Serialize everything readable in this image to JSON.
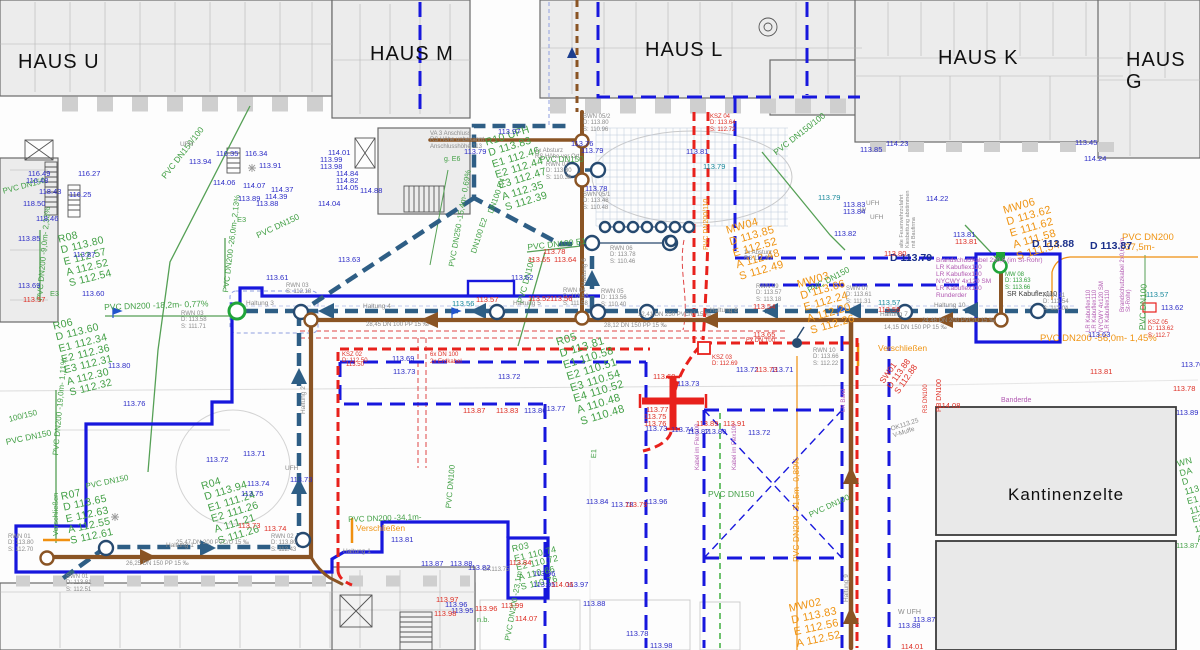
{
  "canvas": {
    "width": 1200,
    "height": 650
  },
  "colors": {
    "boundary_blue": "#1717dd",
    "main_teal": "#2e5e85",
    "pipe_brown": "#8a5424",
    "ksz_red": "#e8211c",
    "existing_green": "#43a046",
    "new_orange": "#ef9413",
    "cable_magenta": "#b25ab2",
    "elev_blue": "#2b2bc6",
    "elev_red": "#dd2e24",
    "building_fill": "#ececec",
    "manhole_navy": "#274a70",
    "marker_green": "#21a53a"
  },
  "labels": [
    [
      "HAUS U",
      18,
      52,
      "bld",
      0,
      20
    ],
    [
      "HAUS M",
      370,
      44,
      "bld",
      0,
      20
    ],
    [
      "HAUS L",
      645,
      40,
      "bld",
      0,
      20
    ],
    [
      "HAUS K",
      938,
      48,
      "bld",
      0,
      20
    ],
    [
      "HAUS G",
      1126,
      50,
      "bld",
      0,
      20
    ],
    [
      "Kantinenzelte",
      1008,
      486,
      "bld",
      0,
      17
    ],
    [
      "R10  UFH\nD  113.83\nE1 112.46\nE2 112.44\nE3 112.47\nA  112.35\nS  112.39",
      484,
      138,
      "gb",
      -17,
      10.5
    ],
    [
      "R08\nD 113.80\nE 112.57\nA 112.52\nS 112.54",
      57,
      235,
      "gb",
      -14,
      10.5
    ],
    [
      "R06\nD  113.60\nE1 112.34\nE2 112.36\nE3 112.31\nA  112.30\nS  112.32",
      52,
      322,
      "gb",
      -14,
      10.5
    ],
    [
      "R07\nD 113.65\nE 112.63\nA 112.55\nS 112.61",
      60,
      492,
      "gb",
      -12,
      10.5
    ],
    [
      "R04\nD  113.94\nE1 111.24\nE2 111.26\nA  111.21\nS  111.26",
      200,
      482,
      "gb",
      -17,
      10.5
    ],
    [
      "R05\nD  113.81\nE1 110.58\nE2 110.51\nE3 110.54\nE4 110.52\nA  110.48\nS  110.48",
      555,
      338,
      "gb",
      -17,
      11
    ],
    [
      "R03\nE1 110.74\nE2 110.72\nA  110.66\nS  110.76",
      511,
      545,
      "gb",
      -13,
      9
    ],
    [
      "WN DA\nD 113.85\nE1 113.2\nE2 113.1\nA 113.0\nS 113.0",
      1176,
      460,
      "gb",
      -15,
      9
    ],
    [
      "MW04\nD 113.85\nE 112.52\nA 112.48\nS 112.49",
      725,
      226,
      "ob",
      -16,
      11
    ],
    [
      "MW03\nD 113.66\nE 112.24\nA 112.20\nS 112.26",
      796,
      280,
      "ob",
      -16,
      11
    ],
    [
      "MW06\nD 113.62\nE 111.62\nA 111.58\nS 111.54",
      1002,
      206,
      "ob",
      -16,
      11
    ],
    [
      "MW02\nD 113.83\nE 112.56\nA 112.52",
      788,
      604,
      "ob",
      -12,
      11
    ],
    [
      "PVC DN150/100",
      160,
      175,
      "g",
      -52,
      8.5
    ],
    [
      "PVC DN150/100",
      772,
      150,
      "g",
      -38,
      8.5
    ],
    [
      "PVC DN150",
      255,
      232,
      "g",
      -25,
      8.5
    ],
    [
      "PVC DN150",
      806,
      287,
      "g",
      -28,
      8.5
    ],
    [
      "PVC DN100  E1",
      527,
      243,
      "g",
      -6,
      8.5
    ],
    [
      "PVC DN100",
      516,
      302,
      "g",
      -75,
      8.5
    ],
    [
      "PVC DN200 -18,2m- 0,77%",
      104,
      303,
      "g",
      -2,
      8.5
    ],
    [
      "PVC DN200 -9,0m- 2,33%",
      36,
      300,
      "g",
      -85,
      8
    ],
    [
      "PVC DN200 -26,0m- 2,13%",
      222,
      292,
      "g",
      -83,
      8
    ],
    [
      "PVC DN250 -15,4m- 0,69%",
      448,
      266,
      "g",
      -80,
      8
    ],
    [
      "DN100 E2",
      470,
      252,
      "g",
      -72,
      8
    ],
    [
      "DN100 E4",
      487,
      212,
      "g",
      -70,
      8
    ],
    [
      "g. E6",
      444,
      156,
      "g",
      0,
      7
    ],
    [
      "PVC DN150",
      540,
      156,
      "g",
      0,
      8
    ],
    [
      "PVC DN150",
      2,
      188,
      "g",
      -15,
      8
    ],
    [
      "100/150",
      8,
      416,
      "g",
      -14,
      8
    ],
    [
      "PVC DN150",
      5,
      438,
      "g",
      -12,
      8.5
    ],
    [
      "PVC DN200 -19,0m- 1,11%",
      52,
      455,
      "g",
      -85,
      8
    ],
    [
      "PVC DN150",
      85,
      483,
      "g",
      -12,
      8
    ],
    [
      "PVC DN200 -34,1m-",
      348,
      516,
      "g",
      -2,
      8
    ],
    [
      "PVC DN100",
      445,
      508,
      "g",
      -85,
      8
    ],
    [
      "PVC DN200 -23,1m",
      504,
      640,
      "g",
      -80,
      8
    ],
    [
      "n.b.",
      477,
      616,
      "g",
      0,
      7.5
    ],
    [
      "PVC DN150",
      708,
      490,
      "g",
      0,
      8.5
    ],
    [
      "PVC DN100",
      808,
      512,
      "g",
      -25,
      8
    ],
    [
      "PVC DN100",
      1138,
      330,
      "g",
      -88,
      8.5
    ],
    [
      "E3",
      50,
      290,
      "g",
      0,
      7.5
    ],
    [
      "E3",
      237,
      216,
      "g",
      0,
      7.5
    ],
    [
      "E1",
      590,
      458,
      "g",
      -88,
      7.5
    ],
    [
      "113.87",
      1176,
      542,
      "g",
      0,
      7.5
    ],
    [
      "MW 08\nD: 113.63\nS: 113.66",
      1005,
      272,
      "gg",
      0,
      6
    ],
    [
      "Verschließen",
      52,
      536,
      "g",
      -90,
      7.5
    ],
    [
      "Verschließen",
      878,
      344,
      "o",
      0,
      8.5
    ],
    [
      "Verschließen",
      356,
      524,
      "o",
      0,
      8.5
    ],
    [
      "PVC DN200 -37,5m-",
      1122,
      233,
      "o",
      0,
      9.5
    ],
    [
      "PVC DN200 -56,0m- 1,45%",
      1040,
      334,
      "o",
      0,
      9.5
    ],
    [
      "PVC DN200/110",
      703,
      250,
      "o",
      -90,
      7
    ],
    [
      "PVC DN200 -31,5m- 0,89%",
      792,
      562,
      "o",
      -90,
      8.5
    ],
    [
      "Brandschutzkabel 2x0,8 (im St-Rohr)\nLR Kabuflex110\nLR Kabuflex110\nNYCWY 4x120 SM\nLR Kabuflex110\nRunderder",
      936,
      257,
      "mb",
      0,
      6.5
    ],
    [
      "SR Kabuflex110",
      1007,
      291,
      "kk",
      0,
      7
    ],
    [
      "LR Kabuflex110\nLR Kabuflex110\nNYCWY 4x120 SM\nLR Kabuflex110",
      1086,
      332,
      "mb",
      -90,
      6
    ],
    [
      "Brandschutzkabel 2x0,6 (im St-Rohr)",
      1120,
      312,
      "m",
      -90,
      6
    ],
    [
      "Kabel im Flex100",
      695,
      470,
      "m",
      -90,
      6
    ],
    [
      "Kabel im Flex100",
      732,
      470,
      "m",
      -90,
      6
    ],
    [
      "Banderde",
      1001,
      397,
      "m",
      0,
      7
    ],
    [
      "LR Band",
      841,
      412,
      "m",
      -90,
      6
    ],
    [
      "SW01\nD 113.88\nS 112.88",
      878,
      380,
      "rb",
      -55,
      8.5
    ],
    [
      "PP DN100",
      936,
      412,
      "r",
      -90,
      7
    ],
    [
      "RS DN100",
      923,
      413,
      "r",
      -90,
      6
    ],
    [
      "KSZ 02\nD: 112.50",
      342,
      352,
      "rg",
      0,
      6
    ],
    [
      "KSZ 03\nD: 112.69",
      712,
      355,
      "rg",
      0,
      6
    ],
    [
      "KSZ 04\nD: 113.64\nS: 112.72",
      710,
      114,
      "rg",
      0,
      6
    ],
    [
      "KSZ 05\nD: 113.62\nS: 112.7",
      1148,
      320,
      "rg",
      0,
      6
    ],
    [
      "Ex DN 100",
      746,
      338,
      "r",
      0,
      6
    ],
    [
      "6x DN 100",
      430,
      352,
      "r",
      0,
      6
    ],
    [
      "2x Erdkabel",
      430,
      359,
      "r",
      0,
      6
    ],
    [
      "OK113.25\nV-Muffe",
      890,
      426,
      "gy",
      -18,
      6.5
    ],
    [
      "RWN 01\nD: 113.80\nS: 112.70",
      8,
      534,
      "gy",
      0,
      6
    ],
    [
      "SWN 01\nD: 113.81\nS: 112.51",
      66,
      574,
      "gy",
      0,
      6
    ],
    [
      "RWN 02\nD: 113.80\nS: 112.43",
      271,
      534,
      "gy",
      0,
      6
    ],
    [
      "RWN 03\nS: 112.18",
      286,
      283,
      "gy",
      0,
      6
    ],
    [
      "RWN 03\nD: 113.58\nS: 111.71",
      181,
      311,
      "gy",
      0,
      6
    ],
    [
      "RWN 04\nD: 113.58\nS: 111.58",
      563,
      288,
      "gy",
      0,
      6
    ],
    [
      "RWN 05\nD: 113.56\nS: 110.40",
      601,
      289,
      "gy",
      0,
      6
    ],
    [
      "RWN 06\nD: 113.78\nS: 110.46",
      610,
      246,
      "gy",
      0,
      6
    ],
    [
      "RWN 07\nD: 113.80\nS: 110.38",
      546,
      162,
      "gy",
      0,
      6
    ],
    [
      "SWN 05/1\nD: 113.48\nS: 110.48",
      583,
      192,
      "gy",
      0,
      6
    ],
    [
      "BWN 05/2\nD: 113.80\nS: 110.96",
      583,
      114,
      "gy",
      0,
      6
    ],
    [
      "RWN 09\nD: 113.57\nS: 113.18",
      756,
      284,
      "gy",
      0,
      6
    ],
    [
      "SWN 07\nD: 113.61\nS: 111.31",
      846,
      286,
      "gy",
      0,
      6
    ],
    [
      "RWN 10\nD: 113.66\nS: 112.22",
      813,
      348,
      "gy",
      0,
      6
    ],
    [
      "RWN 11\nD: 113.54\nS: 112.04",
      1043,
      293,
      "gy",
      0,
      6
    ],
    [
      "VA 3 Anschluss\nRS Höhe unbekannt\nAnschlusshöhe 113",
      430,
      131,
      "gy",
      0,
      6
    ],
    [
      "1x Absturz\nRS Höhe vor Ort",
      535,
      148,
      "gy",
      0,
      6
    ],
    [
      "1x Absturz\nRS 111.30",
      744,
      250,
      "gy",
      0,
      6
    ],
    [
      "alte Feuerwehrzufahrt\nKiesbettung abstimmen\nmit Baufirma",
      900,
      248,
      "gy",
      -90,
      5.5
    ],
    [
      "28,45  DN 100  PP  15 ‰",
      366,
      322,
      "gy",
      0,
      6
    ],
    [
      "26,25  DN 150  PP  15 ‰",
      126,
      561,
      "gy",
      0,
      6
    ],
    [
      "25,47  DN 200  PVC/U  15 ‰",
      176,
      540,
      "gy",
      0,
      6
    ],
    [
      "12,41  DN 250  PVC/U  15 ‰",
      638,
      312,
      "gy",
      0,
      6
    ],
    [
      "28,12  DN 150  PP  15 ‰",
      604,
      323,
      "gy",
      0,
      6
    ],
    [
      "24,46  DN 200  PVC/U  15 ‰",
      922,
      318,
      "gy",
      0,
      6
    ],
    [
      "14,15  DN 150  PP  15 ‰",
      884,
      325,
      "gy",
      0,
      6
    ],
    [
      "Haltung 1",
      166,
      542,
      "gy",
      0,
      6.5
    ],
    [
      "Haltung 1",
      343,
      548,
      "gy",
      0,
      6.5
    ],
    [
      "Haltung 2",
      300,
      414,
      "gy",
      -90,
      6.5
    ],
    [
      "Haltung 3",
      246,
      300,
      "gy",
      0,
      6.5
    ],
    [
      "Haltung 4",
      363,
      303,
      "gy",
      0,
      6.5
    ],
    [
      "Haltung 5",
      513,
      300,
      "gy",
      0,
      6.5
    ],
    [
      "Haltung 6",
      581,
      286,
      "gy",
      -90,
      6.5
    ],
    [
      "Haltung 7",
      880,
      311,
      "gy",
      0,
      6.5
    ],
    [
      "Haltung 8",
      710,
      307,
      "gy",
      0,
      6.5
    ],
    [
      "Haltung 9",
      843,
      602,
      "gy",
      -90,
      6.5
    ],
    [
      "Haltung 10",
      934,
      302,
      "gy",
      0,
      6.5
    ],
    [
      "UFH",
      180,
      141,
      "gy",
      0,
      6.5
    ],
    [
      "UFH",
      285,
      465,
      "gy",
      0,
      6.5
    ],
    [
      "UFH",
      866,
      200,
      "gy",
      0,
      6.5
    ],
    [
      "W",
      860,
      207,
      "gy",
      0,
      6.5
    ],
    [
      "UFH",
      870,
      214,
      "gy",
      0,
      6.5
    ],
    [
      "W UFH",
      898,
      609,
      "gy",
      0,
      7
    ],
    [
      "DK113.75",
      483,
      567,
      "gy",
      0,
      6
    ],
    [
      "D 113.88",
      1032,
      239,
      "db",
      0,
      10.5
    ],
    [
      "D 113.87",
      1090,
      241,
      "db",
      0,
      10.5
    ],
    [
      "D 113.79",
      890,
      253,
      "db",
      0,
      10.5
    ],
    [
      "116.49",
      28,
      170
    ],
    [
      "116.48",
      26,
      177
    ],
    [
      "116.27",
      78,
      170
    ],
    [
      "116.25",
      69,
      191
    ],
    [
      "118.43",
      39,
      188
    ],
    [
      "118.50",
      23,
      200
    ],
    [
      "118.46",
      36,
      215
    ],
    [
      "113.85",
      18,
      235
    ],
    [
      "113.94",
      189,
      158
    ],
    [
      "116.35",
      216,
      150
    ],
    [
      "116.34",
      245,
      150
    ],
    [
      "113.91",
      259,
      162
    ],
    [
      "114.06",
      213,
      179
    ],
    [
      "114.07",
      243,
      182
    ],
    [
      "114.37",
      271,
      186
    ],
    [
      "114.39",
      265,
      193
    ],
    [
      "113.89",
      238,
      195
    ],
    [
      "113.88",
      256,
      200
    ],
    [
      "114.01",
      328,
      149
    ],
    [
      "113.99",
      320,
      156
    ],
    [
      "113.98",
      320,
      163
    ],
    [
      "114.84",
      336,
      170
    ],
    [
      "114.82",
      336,
      177
    ],
    [
      "114.05",
      336,
      184
    ],
    [
      "114.88",
      360,
      187
    ],
    [
      "114.04",
      318,
      200
    ],
    [
      "114.23",
      886,
      140
    ],
    [
      "113.85",
      860,
      146
    ],
    [
      "113.45",
      1075,
      139
    ],
    [
      "114.24",
      1084,
      155
    ],
    [
      "113.87",
      73,
      251
    ],
    [
      "113.69",
      18,
      282
    ],
    [
      "113.60",
      82,
      290
    ],
    [
      "113.80",
      108,
      362
    ],
    [
      "113.76",
      123,
      400
    ],
    [
      "113.61",
      266,
      274
    ],
    [
      "113.63",
      338,
      256
    ],
    [
      "113.62",
      511,
      274
    ],
    [
      "113.78",
      585,
      185
    ],
    [
      "113.79",
      581,
      147
    ],
    [
      "113.76",
      571,
      140
    ],
    [
      "113.97",
      498,
      128
    ],
    [
      "113.79",
      464,
      148
    ],
    [
      "113.81",
      686,
      148
    ],
    [
      "113.83",
      843,
      201
    ],
    [
      "113.84",
      843,
      208
    ],
    [
      "113.82",
      834,
      230
    ],
    [
      "114.22",
      926,
      195
    ],
    [
      "113.81",
      953,
      231
    ],
    [
      "113.71",
      243,
      450
    ],
    [
      "113.72",
      206,
      456
    ],
    [
      "113.74",
      247,
      480
    ],
    [
      "113.75",
      241,
      490
    ],
    [
      "113.73",
      290,
      476
    ],
    [
      "113.69",
      392,
      355
    ],
    [
      "113.73",
      393,
      368
    ],
    [
      "113.72",
      498,
      373
    ],
    [
      "113.86",
      524,
      407
    ],
    [
      "113.77",
      543,
      405
    ],
    [
      "113.72",
      736,
      366
    ],
    [
      "113.71",
      771,
      366
    ],
    [
      "113.73",
      677,
      380
    ],
    [
      "113.73",
      645,
      425
    ],
    [
      "113.74",
      671,
      426
    ],
    [
      "113.82",
      687,
      428
    ],
    [
      "113.80",
      704,
      428
    ],
    [
      "113.72",
      748,
      429
    ],
    [
      "113.81",
      391,
      536
    ],
    [
      "113.87",
      421,
      560
    ],
    [
      "113.88",
      450,
      560
    ],
    [
      "113.82",
      468,
      564
    ],
    [
      "113.96",
      533,
      570
    ],
    [
      "113.95",
      533,
      581
    ],
    [
      "113.97",
      566,
      581
    ],
    [
      "113.96",
      445,
      601
    ],
    [
      "113.95",
      451,
      607
    ],
    [
      "113.84",
      586,
      498
    ],
    [
      "113.78",
      611,
      501
    ],
    [
      "113.96",
      645,
      498
    ],
    [
      "113.62",
      1161,
      304
    ],
    [
      "113.63",
      1088,
      331
    ],
    [
      "113.89",
      1176,
      409
    ],
    [
      "113.70",
      1181,
      361
    ],
    [
      "113.87",
      913,
      616
    ],
    [
      "113.88",
      898,
      622
    ],
    [
      "113.88",
      583,
      600
    ],
    [
      "113.78",
      626,
      630
    ],
    [
      "113.98",
      650,
      642
    ],
    [
      "113.57",
      23,
      296,
      "r"
    ],
    [
      "113.57",
      476,
      296,
      "r"
    ],
    [
      "113.52",
      528,
      295,
      "r"
    ],
    [
      "113.56",
      550,
      295,
      "r"
    ],
    [
      "113.78",
      543,
      248,
      "r"
    ],
    [
      "113.65",
      528,
      256,
      "r"
    ],
    [
      "113.64",
      554,
      256,
      "r"
    ],
    [
      "113.50",
      346,
      362,
      "r",
      0,
      6
    ],
    [
      "113.87",
      463,
      407,
      "r"
    ],
    [
      "113.83",
      496,
      407,
      "r"
    ],
    [
      "113.84",
      509,
      559,
      "r"
    ],
    [
      "113.65",
      753,
      331,
      "r"
    ],
    [
      "113.60",
      653,
      373,
      "r"
    ],
    [
      "113.77",
      646,
      406,
      "r"
    ],
    [
      "113.75",
      644,
      413,
      "r"
    ],
    [
      "113.76",
      644,
      420,
      "r"
    ],
    [
      "113.89",
      696,
      420,
      "r"
    ],
    [
      "113.91",
      723,
      420,
      "r"
    ],
    [
      "113.73",
      755,
      366,
      "r"
    ],
    [
      "113.73",
      238,
      522,
      "r"
    ],
    [
      "113.74",
      264,
      525,
      "r"
    ],
    [
      "113.79",
      625,
      501,
      "r"
    ],
    [
      "113.97",
      436,
      596,
      "r"
    ],
    [
      "113.98",
      434,
      610,
      "r"
    ],
    [
      "113.96",
      475,
      605,
      "r"
    ],
    [
      "113.99",
      501,
      602,
      "r"
    ],
    [
      "114.07",
      515,
      615,
      "r"
    ],
    [
      "114.06",
      551,
      581,
      "r"
    ],
    [
      "113.80",
      884,
      250,
      "r"
    ],
    [
      "113.81",
      955,
      238,
      "r"
    ],
    [
      "113.54",
      753,
      303,
      "r"
    ],
    [
      "114.08",
      938,
      402,
      "r"
    ],
    [
      "113.81",
      1090,
      368,
      "r"
    ],
    [
      "113.78",
      1173,
      385,
      "r"
    ],
    [
      "114.01",
      901,
      643,
      "r"
    ],
    [
      "113.56",
      452,
      300,
      "t"
    ],
    [
      "113.57",
      878,
      299,
      "t"
    ],
    [
      "113.55",
      878,
      306,
      "r"
    ],
    [
      "113.57",
      1146,
      291,
      "t"
    ],
    [
      "113.79",
      703,
      163,
      "t"
    ],
    [
      "113.79",
      818,
      194,
      "t"
    ]
  ]
}
